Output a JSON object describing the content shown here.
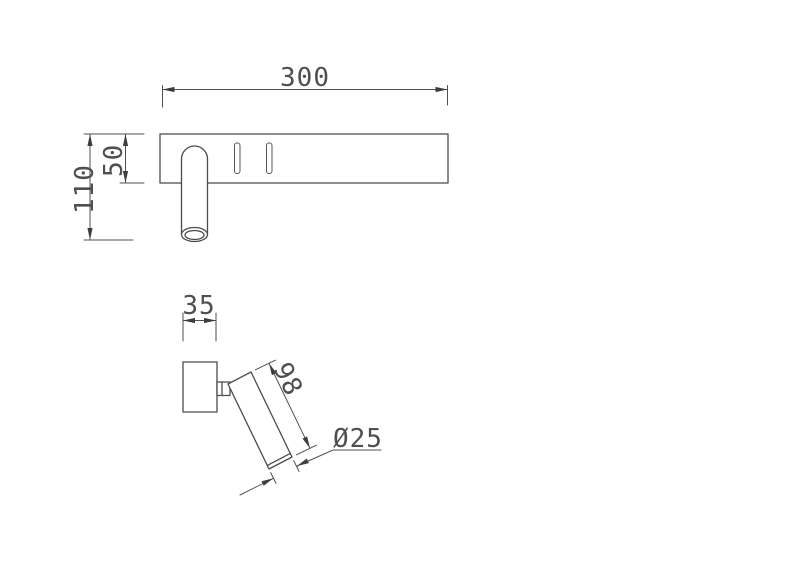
{
  "colors": {
    "background": "#ffffff",
    "line": "#4b4b4b",
    "dimension_text": "#4f4f4f"
  },
  "views": {
    "front": {
      "dimensions": {
        "bar_length": "300",
        "bar_height": "50",
        "overall_height": "110"
      }
    },
    "side": {
      "dimensions": {
        "mount_width": "35",
        "arm_length": "98",
        "arm_diameter": "Ø25"
      }
    }
  }
}
